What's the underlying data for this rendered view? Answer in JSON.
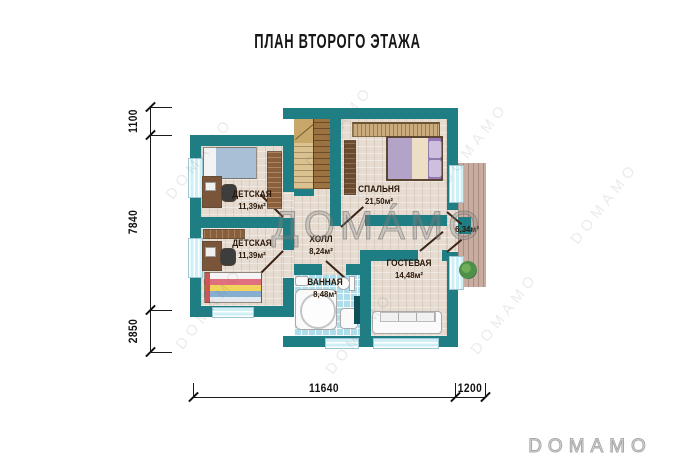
{
  "title": "ПЛАН ВТОРОГО ЭТАЖА",
  "rooms": [
    {
      "name": "ДЕТСКАЯ",
      "area": "11,39м²"
    },
    {
      "name": "СПАЛЬНЯ",
      "area": "21,50м²"
    },
    {
      "name": "ДЕТСКАЯ",
      "area": "11,39м²"
    },
    {
      "name": "ХОЛЛ",
      "area": "8,24м²"
    },
    {
      "name": "ВАННАЯ",
      "area": "8,48м²"
    },
    {
      "name": "ГОСТЕВАЯ",
      "area": "14,48м²"
    },
    {
      "name": "",
      "area": "6,34м²"
    }
  ],
  "dimensions": {
    "left": [
      "1100",
      "7840",
      "2850"
    ],
    "bottom": [
      "11640",
      "1200"
    ]
  },
  "watermark": {
    "center": "ДОМА́МО",
    "tile": "DOMAMO",
    "logo": "DOMAMO"
  },
  "colors": {
    "wall": "#1f7e83",
    "floor": "#e6dcd1",
    "bath_tile": "#aeddeb",
    "deck": "#c9aca0",
    "window": "#cfeff7",
    "door": "#3a2314"
  }
}
